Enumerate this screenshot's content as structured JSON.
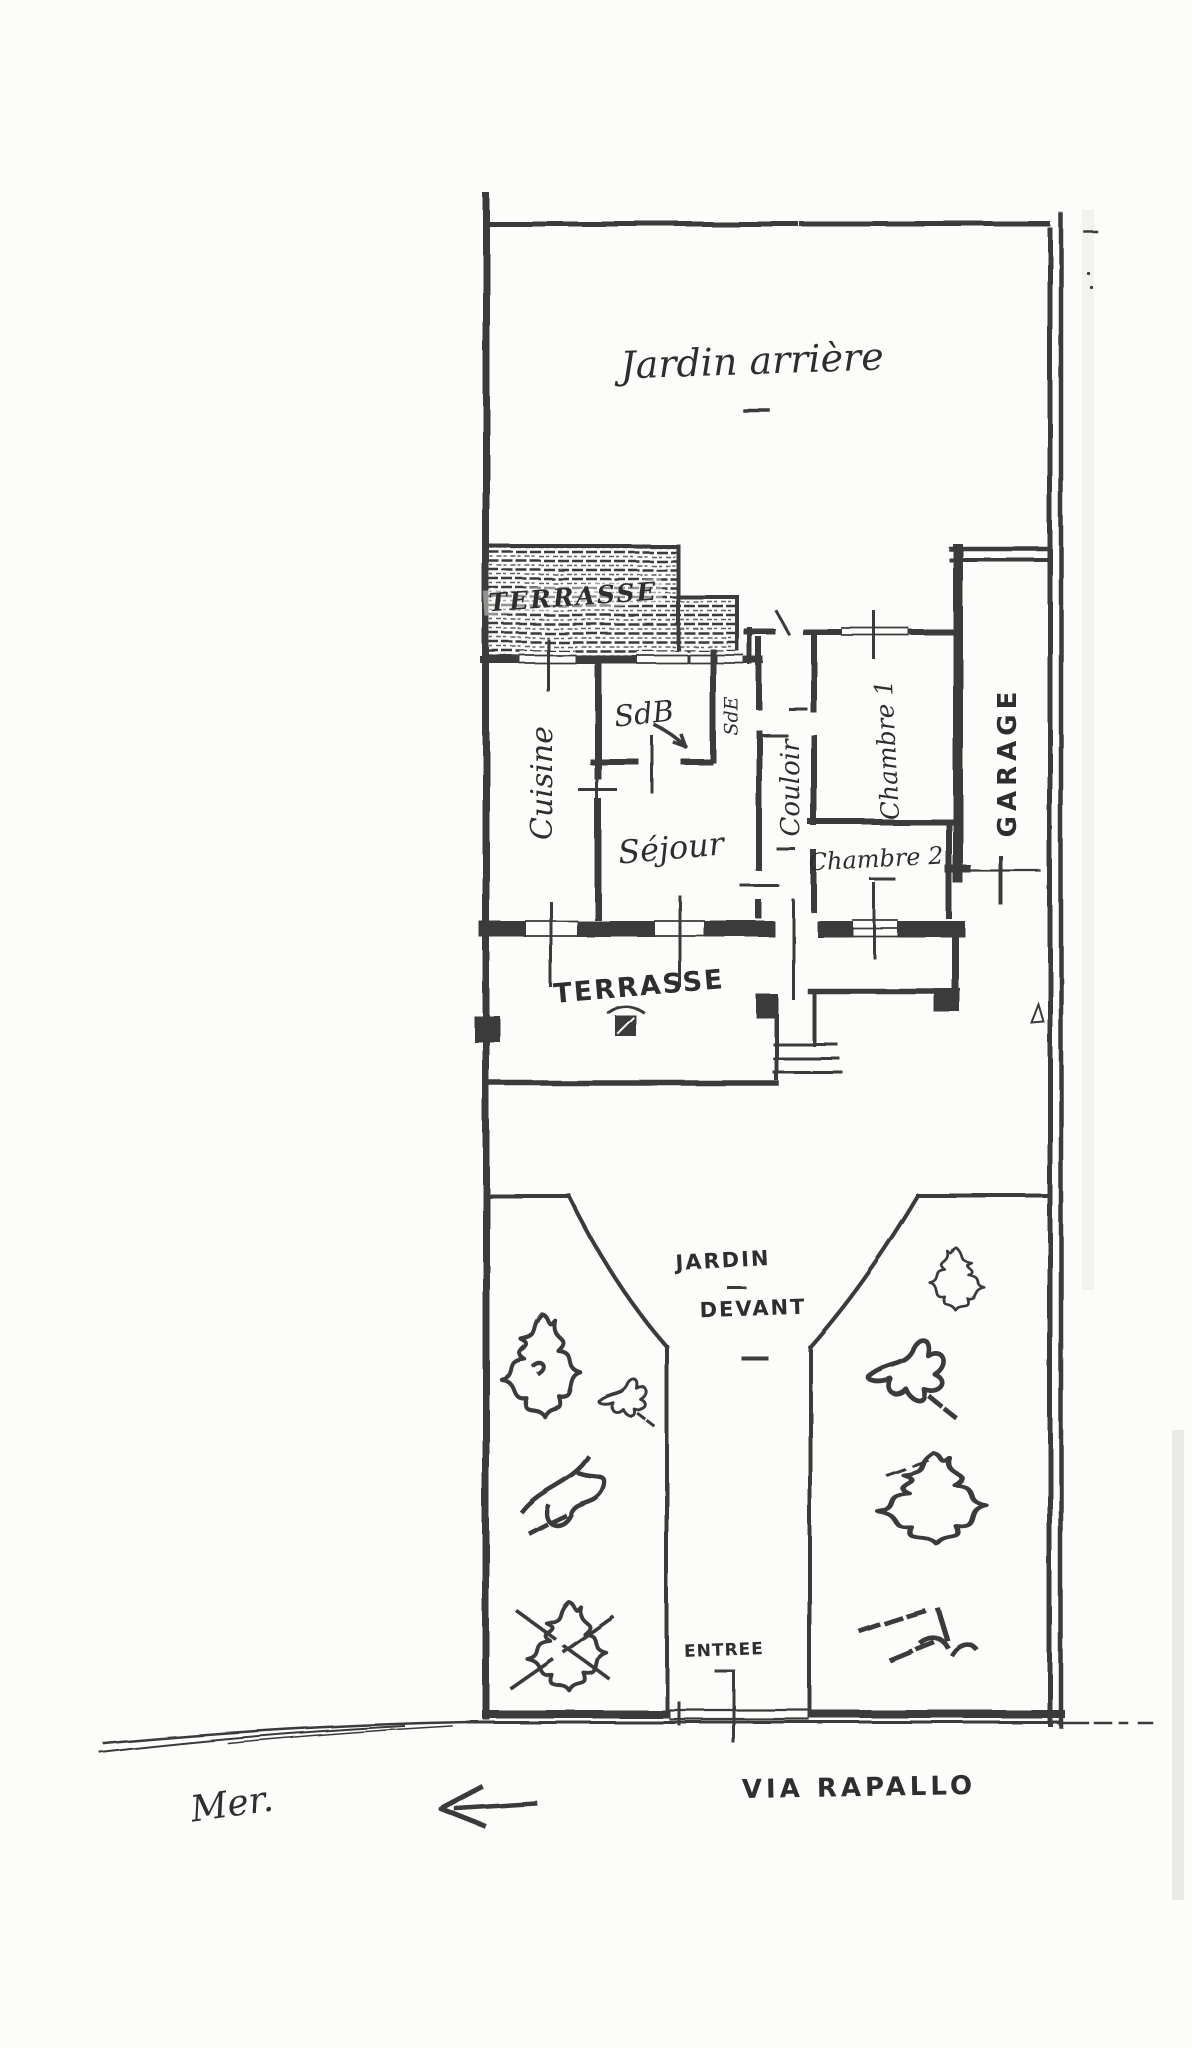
{
  "colors": {
    "ink": "#3a3a3a",
    "paper": "#fcfcfa",
    "text": "#2e2e2e"
  },
  "plan": {
    "back_garden": {
      "label": "Jardin arrière"
    },
    "back_terrace": {
      "label": "TERRASSE"
    },
    "rooms": {
      "kitchen": {
        "label": "Cuisine"
      },
      "bathroom": {
        "label": "SdB"
      },
      "shower_room": {
        "label": "SdE"
      },
      "living_room": {
        "label": "Séjour"
      },
      "hallway": {
        "label": "Couloir"
      },
      "bedroom_1": {
        "label": "Chambre 1"
      },
      "bedroom_2": {
        "label": "Chambre 2"
      },
      "garage": {
        "label": "GARAGE"
      }
    },
    "front_terrace": {
      "label": "TERRASSE"
    },
    "front_garden": {
      "label_line_1": "JARDIN",
      "label_line_2": "DEVANT"
    },
    "entrance": {
      "label": "ENTREE"
    },
    "street": {
      "label": "VIA RAPALLO"
    },
    "sea": {
      "label": "Mer.",
      "arrow_icon": "left-arrow"
    }
  }
}
